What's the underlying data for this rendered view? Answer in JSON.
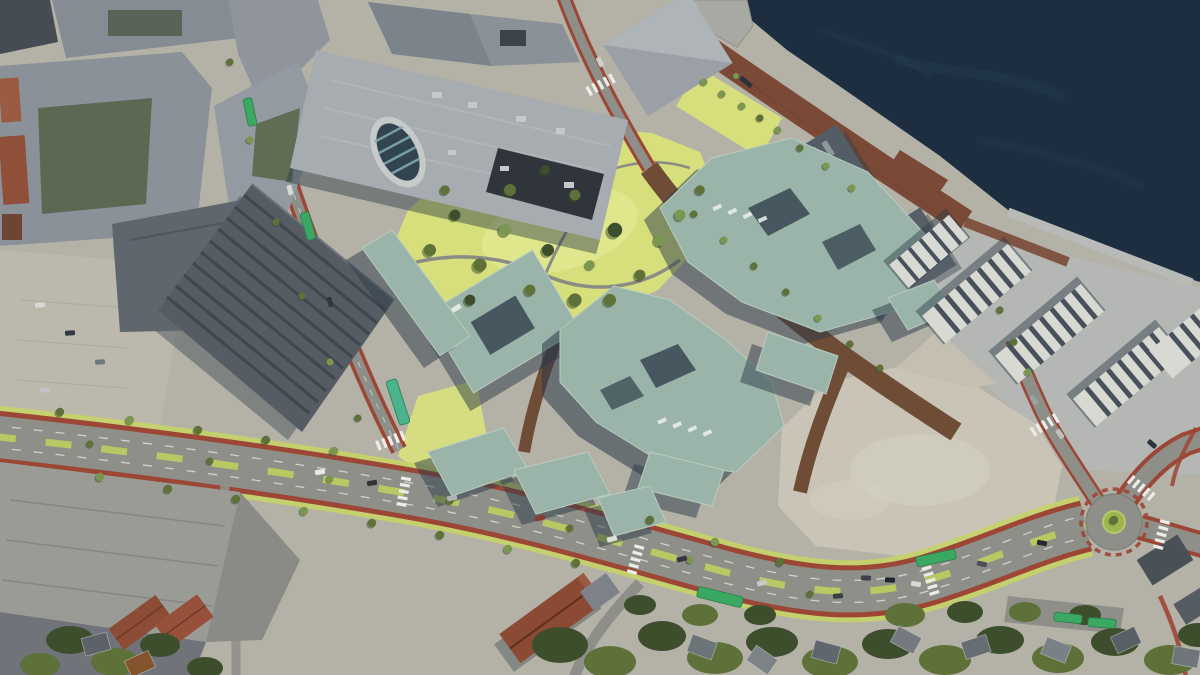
{
  "scene": {
    "type": "aerial-architectural-render",
    "view": "oblique bird's-eye 3D visualization",
    "description": "Aerial 3D render of a waterfront urban development: sage-green proposed building blocks around a yellow-green park, a brown harbour boardwalk along dark sea water, a tree-lined boulevard with red cycle lanes, green buses, a roundabout, a gravel plaza, white apartment slabs by the water, existing grey city blocks, a sawtooth industrial hall and warehouses, with forest and houses along the bottom.",
    "palette": {
      "water": "#1d2e41",
      "water_highlight": "#2c4458",
      "quay_gray": "#b7bab7",
      "boardwalk": "#7a4a36",
      "park_grass": "#d7df7d",
      "park_grass_light": "#e5eb96",
      "verge_green": "#c5d368",
      "tree_dark": "#3c4e2c",
      "tree_mid": "#5d7139",
      "tree_light": "#7b9650",
      "road_asphalt": "#8f8f8a",
      "cycle_lane_red": "#9c4636",
      "internal_street_brown": "#6f4c36",
      "plaza_beige": "#c9c4b6",
      "ground_beige": "#b4b1a7",
      "existing_roof_gray": "#8f959c",
      "existing_roof_dark": "#565c63",
      "mall_roof": "#a7acb1",
      "white_building": "#d9d9d4",
      "brick_red": "#8a4a33",
      "bus_green": "#3aa863",
      "marking_white": "#ecece8",
      "building_shadow": "#2c3b48",
      "proposed_roof": "#9ab4a9",
      "proposed_roof_light": "#aec4b8"
    },
    "regions": [
      {
        "name": "harbor-water"
      },
      {
        "name": "waterfront-boardwalk"
      },
      {
        "name": "waterfront-dark-blocks"
      },
      {
        "name": "proposed-teal-buildings"
      },
      {
        "name": "central-park"
      },
      {
        "name": "mall-with-glass-atrium"
      },
      {
        "name": "northwest-city-blocks"
      },
      {
        "name": "sawtooth-industrial-hall"
      },
      {
        "name": "west-parking-lot"
      },
      {
        "name": "southwest-warehouses"
      },
      {
        "name": "main-boulevard-with-cycle-lanes"
      },
      {
        "name": "west-street"
      },
      {
        "name": "roundabout"
      },
      {
        "name": "gravel-plaza"
      },
      {
        "name": "east-white-apartments"
      },
      {
        "name": "south-forest-and-houses"
      }
    ],
    "counts": {
      "buses": 7,
      "proposed_building_blocks": 10
    }
  }
}
